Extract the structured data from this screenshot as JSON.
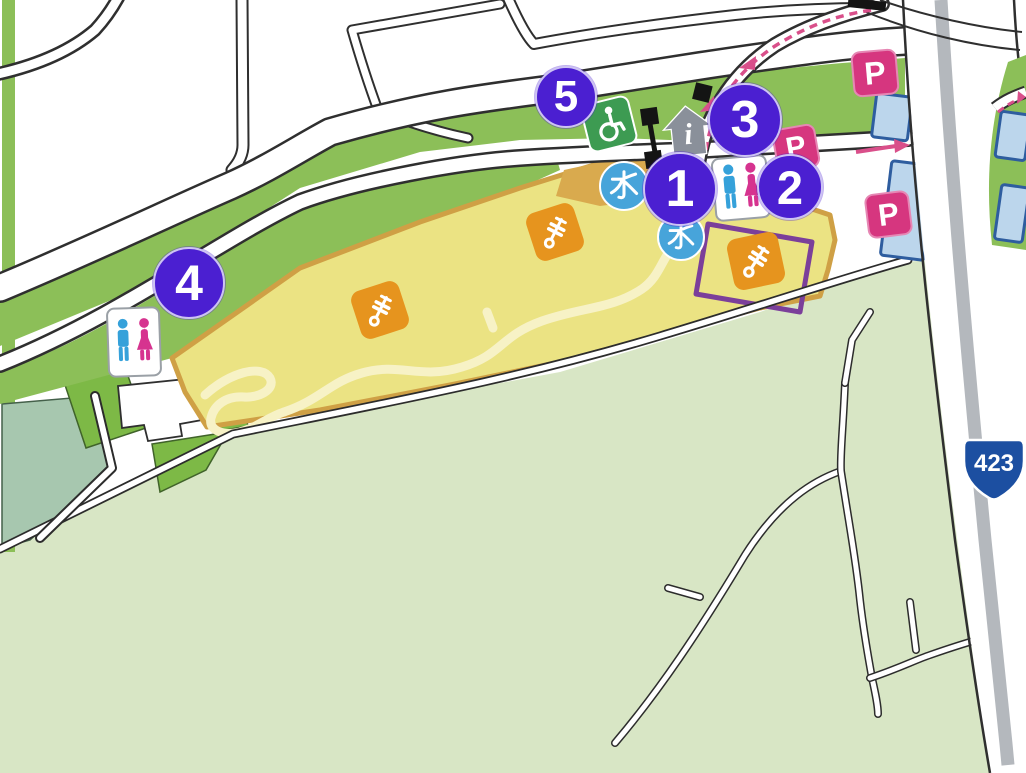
{
  "map": {
    "name": "park-access-guide-map",
    "route_shield": {
      "number": "423"
    },
    "labels": {
      "water": "水",
      "parking": "P",
      "info": "i"
    },
    "markers": [
      {
        "id": "spot-1",
        "label": "1"
      },
      {
        "id": "spot-2",
        "label": "2"
      },
      {
        "id": "spot-3",
        "label": "3"
      },
      {
        "id": "spot-4",
        "label": "4"
      },
      {
        "id": "spot-5",
        "label": "5"
      }
    ],
    "icons": [
      "numbered-spot-marker",
      "water-icon",
      "toilet-icon",
      "wheelchair-accessible-icon",
      "information-icon",
      "parking-icon",
      "exercise-equipment-icon",
      "route-shield-icon",
      "direction-arrow-icon"
    ],
    "colors": {
      "marker": "#4b1fd1",
      "parking_sign": "#d6367f",
      "water": "#47a4da",
      "accessible": "#3d9b52",
      "route_shield": "#1c4fa1",
      "park_fill": "#ebe383",
      "park_border": "#cfa045",
      "park_path": "#f7f2c6",
      "highlight_box": "#7b3f9a",
      "equipment": "#e6941e",
      "toilet_male": "#35a1da",
      "toilet_female": "#d6338f",
      "traffic_arrow": "#d94f8a",
      "green_strip": "#8cbf58",
      "field_green": "#d8e6c5"
    }
  }
}
